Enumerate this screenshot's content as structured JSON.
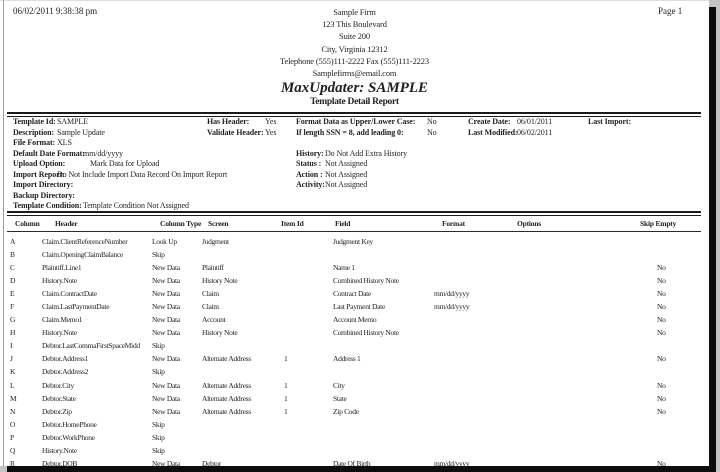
{
  "report": {
    "printed_date": "06/02/2011  9:38:38 pm",
    "page_label": "Page 1",
    "firm_lines": [
      "Sample Firm",
      "123 This Boulevard",
      "Suite 200",
      "City, Virginia 12312",
      "Telephone (555)111-2222  Fax (555)111-2223",
      "Samplefirms@email.com"
    ],
    "title": "MaxUpdater: SAMPLE",
    "subtitle": "Template Detail Report"
  },
  "info": {
    "template_id": {
      "label": "Template Id:",
      "value": "SAMPLE"
    },
    "description": {
      "label": "Description:",
      "value": "Sample Update"
    },
    "file_format": {
      "label": "File Format:",
      "value": "XLS"
    },
    "default_date_format": {
      "label": "Default Date Format:",
      "value": "mm/dd/yyyy"
    },
    "upload_option": {
      "label": "Upload Option:",
      "value": "Mark Data for Upload"
    },
    "import_report": {
      "label": "Import Report:",
      "value": "Do Not Include Import Data Record On Import Report"
    },
    "import_directory": {
      "label": "Import Directory:",
      "value": ""
    },
    "backup_directory": {
      "label": "Backup Directory:",
      "value": ""
    },
    "template_condition": {
      "label": "Template Condition:",
      "value": "Template Condition Not Assigned"
    },
    "has_header": {
      "label": "Has Header:",
      "value": "Yes"
    },
    "validate_header": {
      "label": "Validate Header:",
      "value": "Yes"
    },
    "format_case": {
      "label": "Format Data as Upper/Lower Case:",
      "value": "No"
    },
    "ssn_leading_zero": {
      "label": "If length SSN = 8, add leading 0:",
      "value": "No"
    },
    "history": {
      "label": "History:",
      "value": "Do Not Add Extra History"
    },
    "status": {
      "label": "Status :",
      "value": "Not Assigned"
    },
    "action": {
      "label": "Action :",
      "value": "Not Assigned"
    },
    "activity": {
      "label": "Activity:",
      "value": "Not Assigned"
    },
    "create_date": {
      "label": "Create Date:",
      "value": "06/01/2011"
    },
    "last_modified": {
      "label": "Last Modified:",
      "value": "06/02/2011"
    },
    "last_import": {
      "label": "Last Import:",
      "value": ""
    }
  },
  "table": {
    "headers": {
      "column": "Column",
      "header": "Header",
      "column_type": "Column Type",
      "screen": "Screen",
      "item_id": "Item Id",
      "field": "Field",
      "format": "Format",
      "options": "Options",
      "skip_empty": "Skip Empty"
    },
    "rows": [
      {
        "col": "A",
        "header": "Claim.ClientReferenceNumber",
        "type": "Look Up",
        "screen": "Judgment",
        "item": "",
        "field": "Judgment Key",
        "format": "",
        "options": "",
        "skip": ""
      },
      {
        "col": "B",
        "header": "Claim.OpeningClaimBalance",
        "type": "Skip",
        "screen": "",
        "item": "",
        "field": "",
        "format": "",
        "options": "",
        "skip": ""
      },
      {
        "col": "C",
        "header": "Plaintiff.Line1",
        "type": "New Data",
        "screen": "Plaintiff",
        "item": "",
        "field": "Name 1",
        "format": "",
        "options": "",
        "skip": "No"
      },
      {
        "col": "D",
        "header": "History.Note",
        "type": "New Data",
        "screen": "History Note",
        "item": "",
        "field": "Combined History Note",
        "format": "",
        "options": "",
        "skip": "No"
      },
      {
        "col": "E",
        "header": "Claim.ContractDate",
        "type": "New Data",
        "screen": "Claim",
        "item": "",
        "field": "Contract Date",
        "format": "mm/dd/yyyy",
        "options": "",
        "skip": "No"
      },
      {
        "col": "F",
        "header": "Claim.LastPaymentDate",
        "type": "New Data",
        "screen": "Claim",
        "item": "",
        "field": "Last Payment Date",
        "format": "mm/dd/yyyy",
        "options": "",
        "skip": "No"
      },
      {
        "col": "G",
        "header": "Claim.Memo1",
        "type": "New Data",
        "screen": "Account",
        "item": "",
        "field": "Account Memo",
        "format": "",
        "options": "",
        "skip": "No"
      },
      {
        "col": "H",
        "header": "History.Note",
        "type": "New Data",
        "screen": "History Note",
        "item": "",
        "field": "Combined History Note",
        "format": "",
        "options": "",
        "skip": "No"
      },
      {
        "col": "I",
        "header": "Debtor.LastCommaFirstSpaceMidd",
        "type": "Skip",
        "screen": "",
        "item": "",
        "field": "",
        "format": "",
        "options": "",
        "skip": ""
      },
      {
        "col": "J",
        "header": "Debtor.Address1",
        "type": "New Data",
        "screen": "Alternate Address",
        "item": "1",
        "field": "Address 1",
        "format": "",
        "options": "",
        "skip": "No"
      },
      {
        "col": "K",
        "header": "Debtor.Address2",
        "type": "Skip",
        "screen": "",
        "item": "",
        "field": "",
        "format": "",
        "options": "",
        "skip": ""
      },
      {
        "col": "L",
        "header": "Debtor.City",
        "type": "New Data",
        "screen": "Alternate Address",
        "item": "1",
        "field": "City",
        "format": "",
        "options": "",
        "skip": "No"
      },
      {
        "col": "M",
        "header": "Debtor.State",
        "type": "New Data",
        "screen": "Alternate Address",
        "item": "1",
        "field": "State",
        "format": "",
        "options": "",
        "skip": "No"
      },
      {
        "col": "N",
        "header": "Debtor.Zip",
        "type": "New Data",
        "screen": "Alternate Address",
        "item": "1",
        "field": "Zip Code",
        "format": "",
        "options": "",
        "skip": "No"
      },
      {
        "col": "O",
        "header": "Debtor.HomePhone",
        "type": "Skip",
        "screen": "",
        "item": "",
        "field": "",
        "format": "",
        "options": "",
        "skip": ""
      },
      {
        "col": "P",
        "header": "Debtor.WorkPhone",
        "type": "Skip",
        "screen": "",
        "item": "",
        "field": "",
        "format": "",
        "options": "",
        "skip": ""
      },
      {
        "col": "Q",
        "header": "History.Note",
        "type": "Skip",
        "screen": "",
        "item": "",
        "field": "",
        "format": "",
        "options": "",
        "skip": ""
      },
      {
        "col": "R",
        "header": "Debtor.DOB",
        "type": "New Data",
        "screen": "Debtor",
        "item": "",
        "field": "Date Of Birth",
        "format": "mm/dd/yyyy",
        "options": "",
        "skip": "No"
      }
    ]
  },
  "colors": {
    "text": "#1f1f1f",
    "page_background": "#ffffff",
    "page_edge_shadow": "#0d0d0d",
    "canvas_background": "#c4c4c4"
  }
}
